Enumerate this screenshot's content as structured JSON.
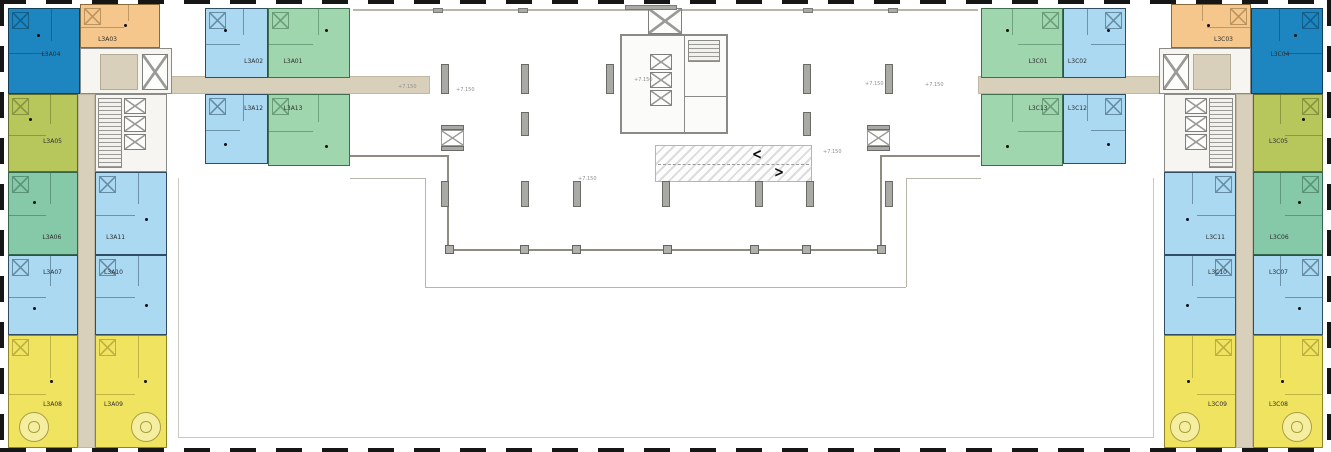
{
  "plan": {
    "kind": "residential floor plan",
    "left_wing_prefix": "L3A",
    "right_wing_prefix": "L3C"
  },
  "palette": {
    "unit_colors": {
      "darkblue": {
        "fill": "#1d86c0",
        "stroke": "#0f3f5c"
      },
      "orange": {
        "fill": "#f5c78d",
        "stroke": "#8a6a3a"
      },
      "lightblue": {
        "fill": "#aad9f1",
        "stroke": "#2f4d63"
      },
      "green": {
        "fill": "#9fd6ae",
        "stroke": "#3f6e4e"
      },
      "teal": {
        "fill": "#85c9a8",
        "stroke": "#37664e"
      },
      "olive": {
        "fill": "#b7c75c",
        "stroke": "#5f6b28"
      },
      "yellow": {
        "fill": "#f0e360",
        "stroke": "#8f8526"
      }
    },
    "corridor": "#d8d0ba",
    "column": "#a9a9a6",
    "dash_border": "#161616"
  },
  "units": [
    {
      "label": "L3A04",
      "color": "darkblue",
      "x": 8,
      "y": 8,
      "w": 72,
      "h": 86,
      "lx": 60,
      "ly": 55,
      "dx": 40,
      "dy": 30
    },
    {
      "label": "L3A03",
      "color": "orange",
      "x": 80,
      "y": 4,
      "w": 80,
      "h": 44,
      "lx": 34,
      "ly": 84,
      "dx": 55,
      "dy": 45
    },
    {
      "label": "L3A02",
      "color": "lightblue",
      "x": 205,
      "y": 8,
      "w": 63,
      "h": 70,
      "lx": 78,
      "ly": 78,
      "dx": 30,
      "dy": 30
    },
    {
      "label": "L3A01",
      "color": "green",
      "x": 268,
      "y": 8,
      "w": 82,
      "h": 70,
      "lx": 30,
      "ly": 78,
      "dx": 70,
      "dy": 30
    },
    {
      "label": "L3A12",
      "color": "lightblue",
      "x": 205,
      "y": 94,
      "w": 63,
      "h": 70,
      "lx": 78,
      "ly": 20,
      "dx": 30,
      "dy": 70
    },
    {
      "label": "L3A13",
      "color": "green",
      "x": 268,
      "y": 94,
      "w": 82,
      "h": 72,
      "lx": 30,
      "ly": 20,
      "dx": 70,
      "dy": 72
    },
    {
      "label": "L3A05",
      "color": "olive",
      "x": 8,
      "y": 94,
      "w": 70,
      "h": 78,
      "lx": 64,
      "ly": 62,
      "dx": 30,
      "dy": 30
    },
    {
      "label": "L3A06",
      "color": "teal",
      "x": 8,
      "y": 172,
      "w": 70,
      "h": 83,
      "lx": 63,
      "ly": 80,
      "dx": 35,
      "dy": 35
    },
    {
      "label": "L3A07",
      "color": "lightblue",
      "x": 8,
      "y": 255,
      "w": 70,
      "h": 80,
      "lx": 64,
      "ly": 22,
      "dx": 35,
      "dy": 65
    },
    {
      "label": "L3A08",
      "color": "yellow",
      "x": 8,
      "y": 335,
      "w": 70,
      "h": 113,
      "lx": 64,
      "ly": 62,
      "dx": 60,
      "dy": 40
    },
    {
      "label": "L3A11",
      "color": "lightblue",
      "x": 95,
      "y": 172,
      "w": 72,
      "h": 83,
      "lx": 28,
      "ly": 80,
      "dx": 70,
      "dy": 55
    },
    {
      "label": "L3A10",
      "color": "lightblue",
      "x": 95,
      "y": 255,
      "w": 72,
      "h": 80,
      "lx": 25,
      "ly": 22,
      "dx": 70,
      "dy": 62
    },
    {
      "label": "L3A09",
      "color": "yellow",
      "x": 95,
      "y": 335,
      "w": 72,
      "h": 113,
      "lx": 25,
      "ly": 62,
      "dx": 68,
      "dy": 40
    },
    {
      "label": "L3C04",
      "color": "darkblue",
      "x": 1251,
      "y": 8,
      "w": 72,
      "h": 86,
      "lx": 40,
      "ly": 55,
      "dx": 60,
      "dy": 30
    },
    {
      "label": "L3C03",
      "color": "orange",
      "x": 1171,
      "y": 4,
      "w": 80,
      "h": 44,
      "lx": 66,
      "ly": 84,
      "dx": 45,
      "dy": 45
    },
    {
      "label": "L3C02",
      "color": "lightblue",
      "x": 1063,
      "y": 8,
      "w": 63,
      "h": 70,
      "lx": 22,
      "ly": 78,
      "dx": 70,
      "dy": 30
    },
    {
      "label": "L3C01",
      "color": "green",
      "x": 981,
      "y": 8,
      "w": 82,
      "h": 70,
      "lx": 70,
      "ly": 78,
      "dx": 30,
      "dy": 30
    },
    {
      "label": "L3C12",
      "color": "lightblue",
      "x": 1063,
      "y": 94,
      "w": 63,
      "h": 70,
      "lx": 22,
      "ly": 20,
      "dx": 70,
      "dy": 70
    },
    {
      "label": "L3C13",
      "color": "green",
      "x": 981,
      "y": 94,
      "w": 82,
      "h": 72,
      "lx": 70,
      "ly": 20,
      "dx": 30,
      "dy": 72
    },
    {
      "label": "L3C05",
      "color": "olive",
      "x": 1253,
      "y": 94,
      "w": 70,
      "h": 78,
      "lx": 36,
      "ly": 62,
      "dx": 70,
      "dy": 30
    },
    {
      "label": "L3C06",
      "color": "teal",
      "x": 1253,
      "y": 172,
      "w": 70,
      "h": 83,
      "lx": 37,
      "ly": 80,
      "dx": 65,
      "dy": 35
    },
    {
      "label": "L3C07",
      "color": "lightblue",
      "x": 1253,
      "y": 255,
      "w": 70,
      "h": 80,
      "lx": 36,
      "ly": 22,
      "dx": 65,
      "dy": 65
    },
    {
      "label": "L3C08",
      "color": "yellow",
      "x": 1253,
      "y": 335,
      "w": 70,
      "h": 113,
      "lx": 36,
      "ly": 62,
      "dx": 40,
      "dy": 40
    },
    {
      "label": "L3C11",
      "color": "lightblue",
      "x": 1164,
      "y": 172,
      "w": 72,
      "h": 83,
      "lx": 72,
      "ly": 80,
      "dx": 30,
      "dy": 55
    },
    {
      "label": "L3C10",
      "color": "lightblue",
      "x": 1164,
      "y": 255,
      "w": 72,
      "h": 80,
      "lx": 75,
      "ly": 22,
      "dx": 30,
      "dy": 62
    },
    {
      "label": "L3C09",
      "color": "yellow",
      "x": 1164,
      "y": 335,
      "w": 72,
      "h": 113,
      "lx": 75,
      "ly": 62,
      "dx": 32,
      "dy": 40
    }
  ],
  "ramp": {
    "x": 655,
    "y": 145,
    "w": 157,
    "h": 37,
    "arrow_left": "<",
    "arrow_right": ">"
  },
  "annotations": [
    {
      "text": "+7.150",
      "x": 398,
      "y": 85
    },
    {
      "text": "+7.150",
      "x": 456,
      "y": 88
    },
    {
      "text": "+7.150",
      "x": 865,
      "y": 82
    },
    {
      "text": "+7.150",
      "x": 925,
      "y": 83
    },
    {
      "text": "+7.150",
      "x": 634,
      "y": 78
    },
    {
      "text": "+7.150",
      "x": 823,
      "y": 150
    },
    {
      "text": "+7.150",
      "x": 578,
      "y": 177
    }
  ],
  "structures": {
    "columns": [
      {
        "x": 441,
        "y": 64,
        "w": 8,
        "h": 30
      },
      {
        "x": 521,
        "y": 64,
        "w": 8,
        "h": 30
      },
      {
        "x": 606,
        "y": 64,
        "w": 8,
        "h": 30
      },
      {
        "x": 803,
        "y": 64,
        "w": 8,
        "h": 30
      },
      {
        "x": 885,
        "y": 64,
        "w": 8,
        "h": 30
      },
      {
        "x": 521,
        "y": 112,
        "w": 8,
        "h": 24
      },
      {
        "x": 803,
        "y": 112,
        "w": 8,
        "h": 24
      },
      {
        "x": 441,
        "y": 181,
        "w": 8,
        "h": 26
      },
      {
        "x": 521,
        "y": 181,
        "w": 8,
        "h": 26
      },
      {
        "x": 573,
        "y": 181,
        "w": 8,
        "h": 26
      },
      {
        "x": 662,
        "y": 181,
        "w": 8,
        "h": 26
      },
      {
        "x": 755,
        "y": 181,
        "w": 8,
        "h": 26
      },
      {
        "x": 806,
        "y": 181,
        "w": 8,
        "h": 26
      },
      {
        "x": 885,
        "y": 181,
        "w": 8,
        "h": 26
      }
    ],
    "railing_posts": {
      "y": 245,
      "size": 9,
      "x": [
        445,
        520,
        572,
        663,
        750,
        802,
        877
      ]
    },
    "wall_clips": [
      {
        "x": 433,
        "y": 8,
        "w": 10,
        "h": 5
      },
      {
        "x": 518,
        "y": 8,
        "w": 10,
        "h": 5
      },
      {
        "x": 803,
        "y": 8,
        "w": 10,
        "h": 5
      },
      {
        "x": 888,
        "y": 8,
        "w": 10,
        "h": 5
      },
      {
        "x": 625,
        "y": 5,
        "w": 52,
        "h": 5
      }
    ],
    "shaft_boxes": [
      {
        "x": 441,
        "y": 125,
        "w": 23,
        "h": 26
      },
      {
        "x": 867,
        "y": 125,
        "w": 23,
        "h": 26
      }
    ]
  },
  "decorations": {
    "circles": [
      {
        "cx": 34,
        "cy": 427,
        "r": 15
      },
      {
        "cx": 146,
        "cy": 427,
        "r": 15
      },
      {
        "cx": 1185,
        "cy": 427,
        "r": 15
      },
      {
        "cx": 1297,
        "cy": 427,
        "r": 15
      }
    ]
  }
}
